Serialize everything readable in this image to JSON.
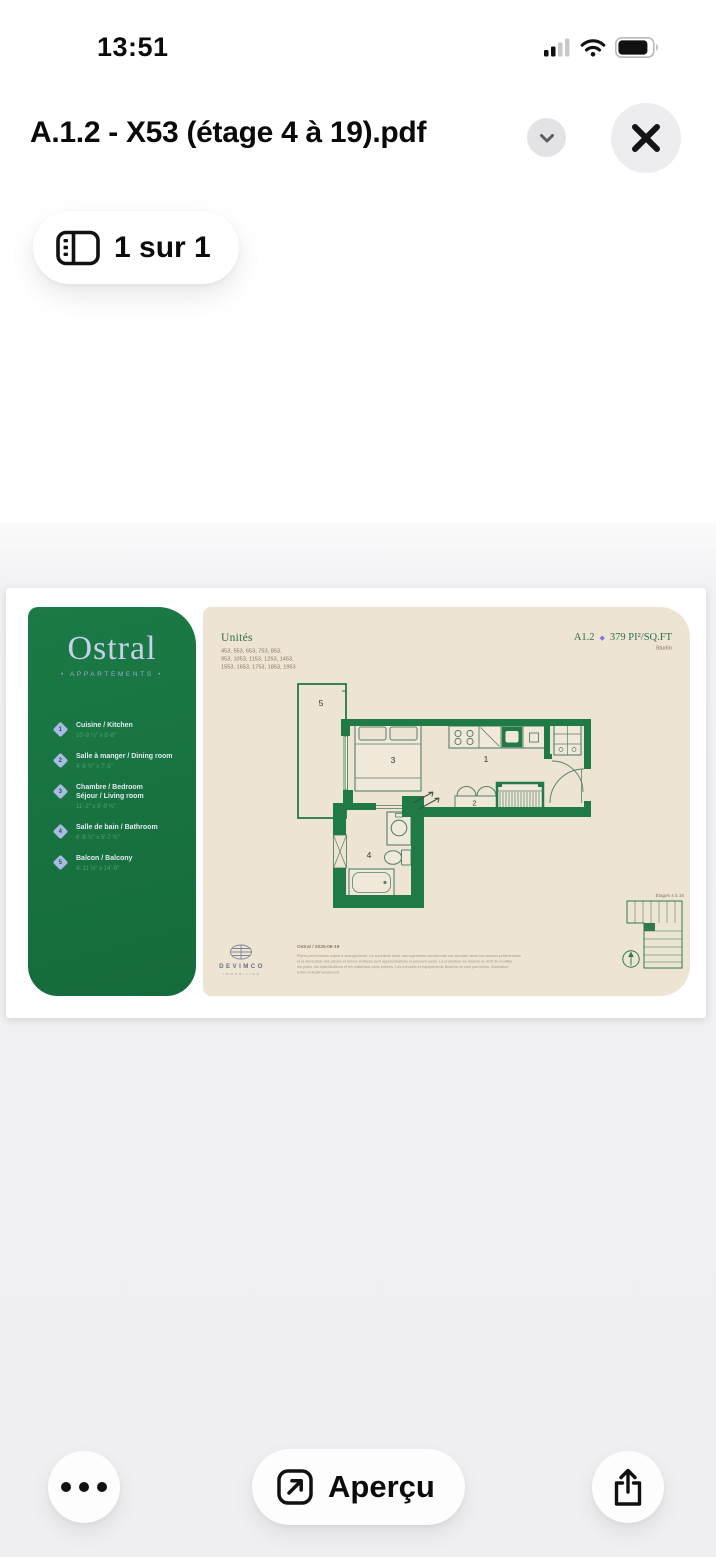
{
  "status_bar": {
    "time": "13:51"
  },
  "header": {
    "title": "A.1.2 - X53 (étage 4 à 19).pdf"
  },
  "page_indicator": {
    "label": "1 sur 1"
  },
  "pdf": {
    "brand": {
      "name": "Ostral",
      "tagline": "• APPARTEMENTS •"
    },
    "legend": [
      {
        "num": "1",
        "title": "Cuisine / Kitchen",
        "dims": "10'-9 ¼\" x 8'-8\""
      },
      {
        "num": "2",
        "title": "Salle à manger / Dining room",
        "dims": "4'-8 ½\" x 7'-5\""
      },
      {
        "num": "3",
        "title": "Chambre / Bedroom",
        "title2": "Séjour / Living room",
        "dims": "11'-2\" x 9'-0 ½\""
      },
      {
        "num": "4",
        "title": "Salle de bain / Bathroom",
        "dims": "6'-8 ½\" x 5'-7 ¾\""
      },
      {
        "num": "5",
        "title": "Balcon / Balcony",
        "dims": "4'-11 ½\" x 14'-9\""
      }
    ],
    "units_heading": "Unités",
    "units_lines": [
      "453, 553, 653, 753, 853,",
      "953, 1053, 1153, 1253, 1453,",
      "1553, 1653, 1753, 1853, 1953"
    ],
    "plan_code": "A1.2",
    "plan_separator": "◆",
    "plan_area": "379 PI²/SQ.FT",
    "plan_type": "Studio",
    "rooms": {
      "kitchen": "1",
      "dining": "2",
      "bedroom": "3",
      "bathroom": "4",
      "balcony": "5"
    },
    "key_plan_label": "Étages 4 à 19",
    "footer": {
      "logo": "DEVIMCO",
      "logo_sub": "IMMOBILIER",
      "date_line": "Ostral / 2025-08-19",
      "disclaimer_lines": [
        "Plans préliminaires sujets à changements. La superficie brute des logements mentionnée est calculée selon les dessins préliminaires",
        "et la dimension des pièces et autres surfaces sont approximatives et peuvent varier. Le promoteur se réserve le droit de modifier",
        "les plans, les spécifications et les matériaux sans préavis. Les meubles et équipements illustrés ne sont pas inclus. Illustration",
        "à titre indicatif seulement."
      ]
    }
  },
  "toolbar": {
    "preview_label": "Aperçu"
  },
  "colors": {
    "brand_green": "#17713f",
    "wall_green": "#1f7a46",
    "cream": "#ede4d4",
    "accent_purple": "#8577d6"
  }
}
